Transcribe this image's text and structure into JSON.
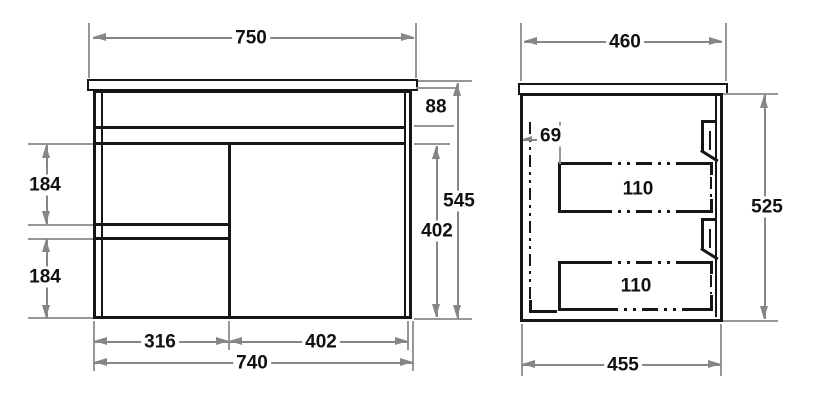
{
  "diagram": {
    "kind": "cabinet-dimension-drawing",
    "colors": {
      "object_line": "#161616",
      "dimension_line": "#868686",
      "text": "#111111",
      "background": "#ffffff"
    },
    "front_view": {
      "dims": {
        "top_width": "750",
        "band_height": "88",
        "total_height": "545",
        "opening_height": "402",
        "upper_drawer_height": "184",
        "lower_drawer_height": "184",
        "drawer_column_width": "316",
        "door_width": "402",
        "body_width": "740"
      }
    },
    "side_view": {
      "dims": {
        "top_depth": "460",
        "back_clearance": "69",
        "upper_drawer_depth": "110",
        "lower_drawer_depth": "110",
        "body_height": "525",
        "bottom_depth": "455"
      }
    }
  }
}
